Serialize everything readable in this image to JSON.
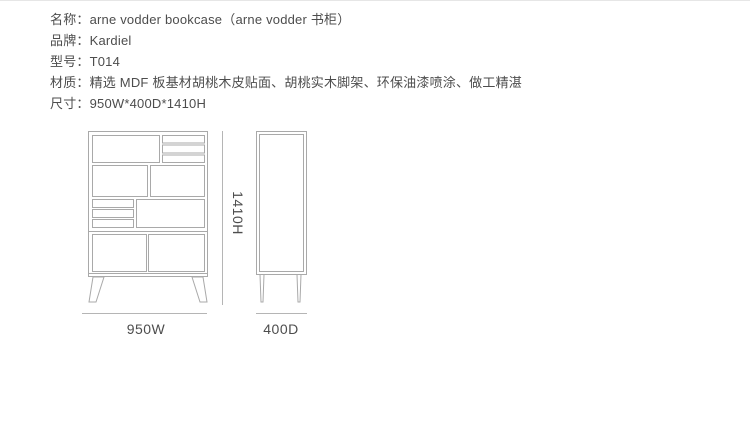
{
  "colors": {
    "background": "#ffffff",
    "top_border": "#e6e6e6",
    "text": "#4d4d4d",
    "drawing_line": "#a9a9a9",
    "dimension_line": "#b5b5b5"
  },
  "specs": [
    {
      "text": "名称：arne vodder bookcase（arne vodder 书柜）"
    },
    {
      "text": "品牌：Kardiel"
    },
    {
      "text": "型号：T014"
    },
    {
      "text": "材质：精选 MDF 板基材胡桃木皮贴面、胡桃实木脚架、环保油漆喷涂、做工精湛"
    },
    {
      "text": "尺寸：950W*400D*1410H"
    }
  ],
  "diagram": {
    "width_label": "950W",
    "depth_label": "400D",
    "height_label": "1410H"
  }
}
